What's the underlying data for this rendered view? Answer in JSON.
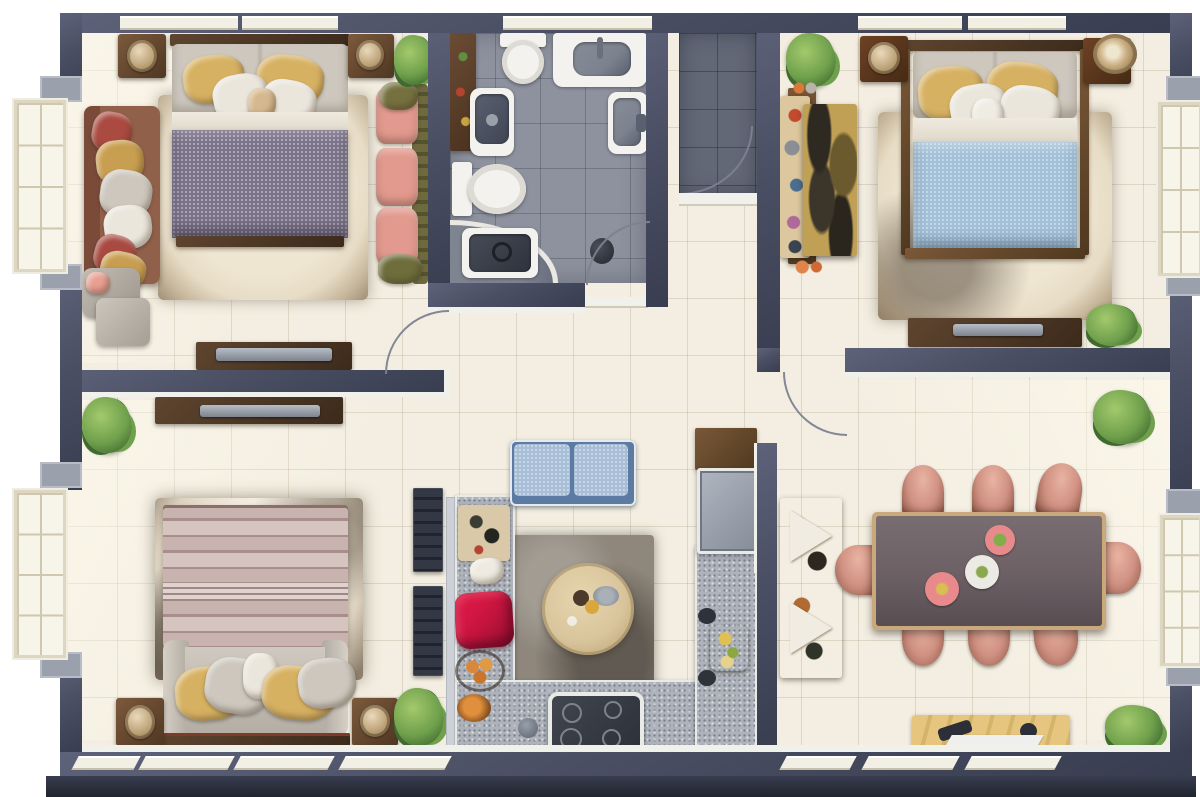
{
  "title": "Apartment floor plan, top-down 3D render, no text labels",
  "palette": {
    "wall": "#4a4f63",
    "wall_light": "#5d627a",
    "wall_dark": "#383d50",
    "trim_white": "#f1f1ec",
    "sill": "#f2efe5",
    "floor_cream": "#f3eee1",
    "bath_tile": "#8e929e",
    "entry_tile": "#636877",
    "counter": "#aeb3bb",
    "rug_beige": "#e7dcc5",
    "rug_dark": "#8f877c",
    "wood_mid": "#7a5838",
    "wood_dark": "#50391f",
    "bed_purple": "#7b7389",
    "bed_blue": "#a2c0d8",
    "bed_pink": "#c9b3af",
    "pillow_yellow": "#d7b162",
    "pillow_gray": "#cdc7be",
    "pillow_white": "#eae6dc",
    "sofa_brown": "#91604a",
    "sofa_pink": "#e39a8e",
    "olive": "#75713f",
    "sofa_blue": "#a7bed6",
    "sofa_blue_dark": "#5b7ba3",
    "chair_pink": "#d09182",
    "chair_dark": "#8e5847",
    "table_dark": "#6d6166",
    "table_rim": "#c9a87c",
    "round_table": "#d9c59c",
    "sideboard": "#e6c67e",
    "accent_red": "#c2143e",
    "plant": "#6fa04c",
    "plant_dark": "#3f6b2e",
    "plant_light": "#a3c96c",
    "fixture_white": "#f3f2ee",
    "fixture_gray": "#7c828e",
    "fixture_dark": "#3c414c"
  },
  "rooms": [
    {
      "id": "bedroom-top-left",
      "label": "Bedroom top-left",
      "furniture": [
        "double-bed-purple",
        "area-rug",
        "brown-sofa",
        "pink-chaise",
        "nightstand-left",
        "nightstand-right",
        "decor-bowls",
        "tv-console",
        "armchair-ottoman",
        "plant"
      ]
    },
    {
      "id": "bathroom",
      "label": "Bathroom",
      "furniture": [
        "bathtub-counter",
        "toilet",
        "toilet",
        "dark-vanity-sink",
        "wall-basin",
        "corner-shower-vanity",
        "storage-shelf",
        "door"
      ]
    },
    {
      "id": "entry-hall",
      "label": "Entry hall",
      "furniture": [
        "entry-door"
      ]
    },
    {
      "id": "bedroom-top-right",
      "label": "Bedroom top-right",
      "furniture": [
        "double-bed-blue",
        "area-rug",
        "nightstand-left",
        "nightstand-right",
        "patterned-wardrobe",
        "tv-console",
        "plant",
        "plant"
      ]
    },
    {
      "id": "bedroom-bottom-left",
      "label": "Bedroom bottom-left",
      "furniture": [
        "double-bed-striped",
        "marble-rug",
        "nightstand-left",
        "nightstand-right",
        "tv-console",
        "wall-shelf",
        "wall-shelf",
        "plant",
        "plant"
      ]
    },
    {
      "id": "kitchen",
      "label": "Kitchen",
      "furniture": [
        "u-counter",
        "cooktop",
        "refrigerator",
        "bench-sofa-blue",
        "round-table",
        "dark-rug",
        "red-cushion",
        "cutting-board",
        "fruit-bowls",
        "side-tray"
      ]
    },
    {
      "id": "dining-room",
      "label": "Dining room",
      "furniture": [
        "dining-table",
        "chairs-x8",
        "plates-x3",
        "sideboard",
        "display-cabinet",
        "plant",
        "plant",
        "door"
      ]
    }
  ],
  "windows": {
    "top": 5,
    "bottom": 7,
    "left": 2,
    "right": 2
  }
}
